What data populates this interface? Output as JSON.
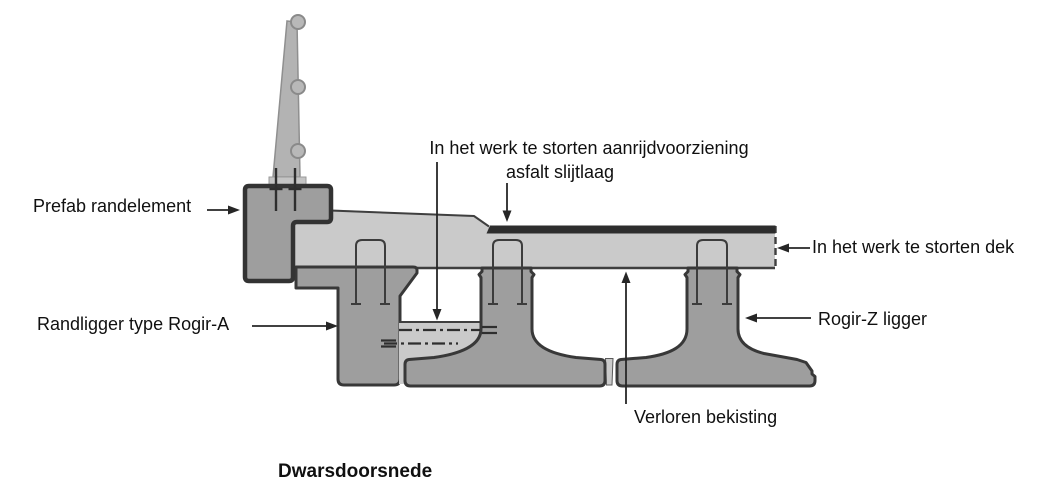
{
  "diagram": {
    "kind": "bridge-deck-cross-section",
    "caption": "Dwarsdoorsnede",
    "labels": {
      "prefab_randelement": "Prefab randelement",
      "aanrijdvoorziening_line1": "In het werk te storten aanrijdvoorziening",
      "aanrijdvoorziening_line2": "asfalt slijtlaag",
      "in_het_werk_dek": "In het werk te storten dek",
      "randligger_rogir_a": "Randligger type Rogir-A",
      "rogir_z_ligger": "Rogir-Z ligger",
      "verloren_bekisting": "Verloren bekisting"
    },
    "colors": {
      "background": "#ffffff",
      "cast_in_situ_concrete": "#cacaca",
      "precast_concrete": "#9e9e9e",
      "outline": "#383838",
      "asphalt": "#2d2d2d",
      "railing": "#b3b3b3",
      "text": "#101010"
    }
  }
}
